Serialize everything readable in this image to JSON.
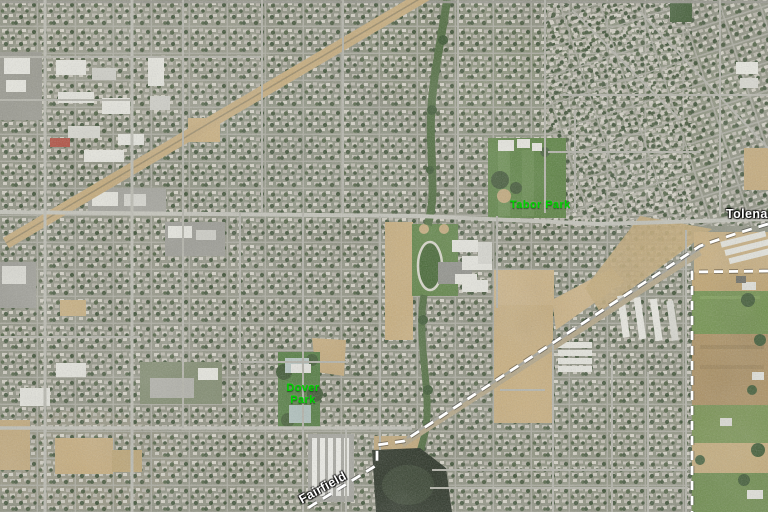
{
  "map": {
    "labels": {
      "tabor_park": {
        "text": "Tabor Park",
        "category": "park",
        "color": "#00d400"
      },
      "dover_park": {
        "line1": "Dover",
        "line2": "Park",
        "category": "park",
        "color": "#00d400"
      },
      "tolenas": {
        "text": "Tolenas",
        "category": "place",
        "color": "#ffffff"
      },
      "fairfield": {
        "text": "Fairfield",
        "category": "place",
        "color": "#ffffff"
      }
    },
    "boundaries": {
      "city_limit_style": "dashed",
      "color": "#ffffff"
    },
    "terrain_colors": {
      "urban_base": "#8e9180",
      "park_green": "#55803b",
      "field_tan": "#c9ae7c",
      "marsh_dark": "#252e20",
      "road_gray": "#b6b6ac"
    }
  }
}
